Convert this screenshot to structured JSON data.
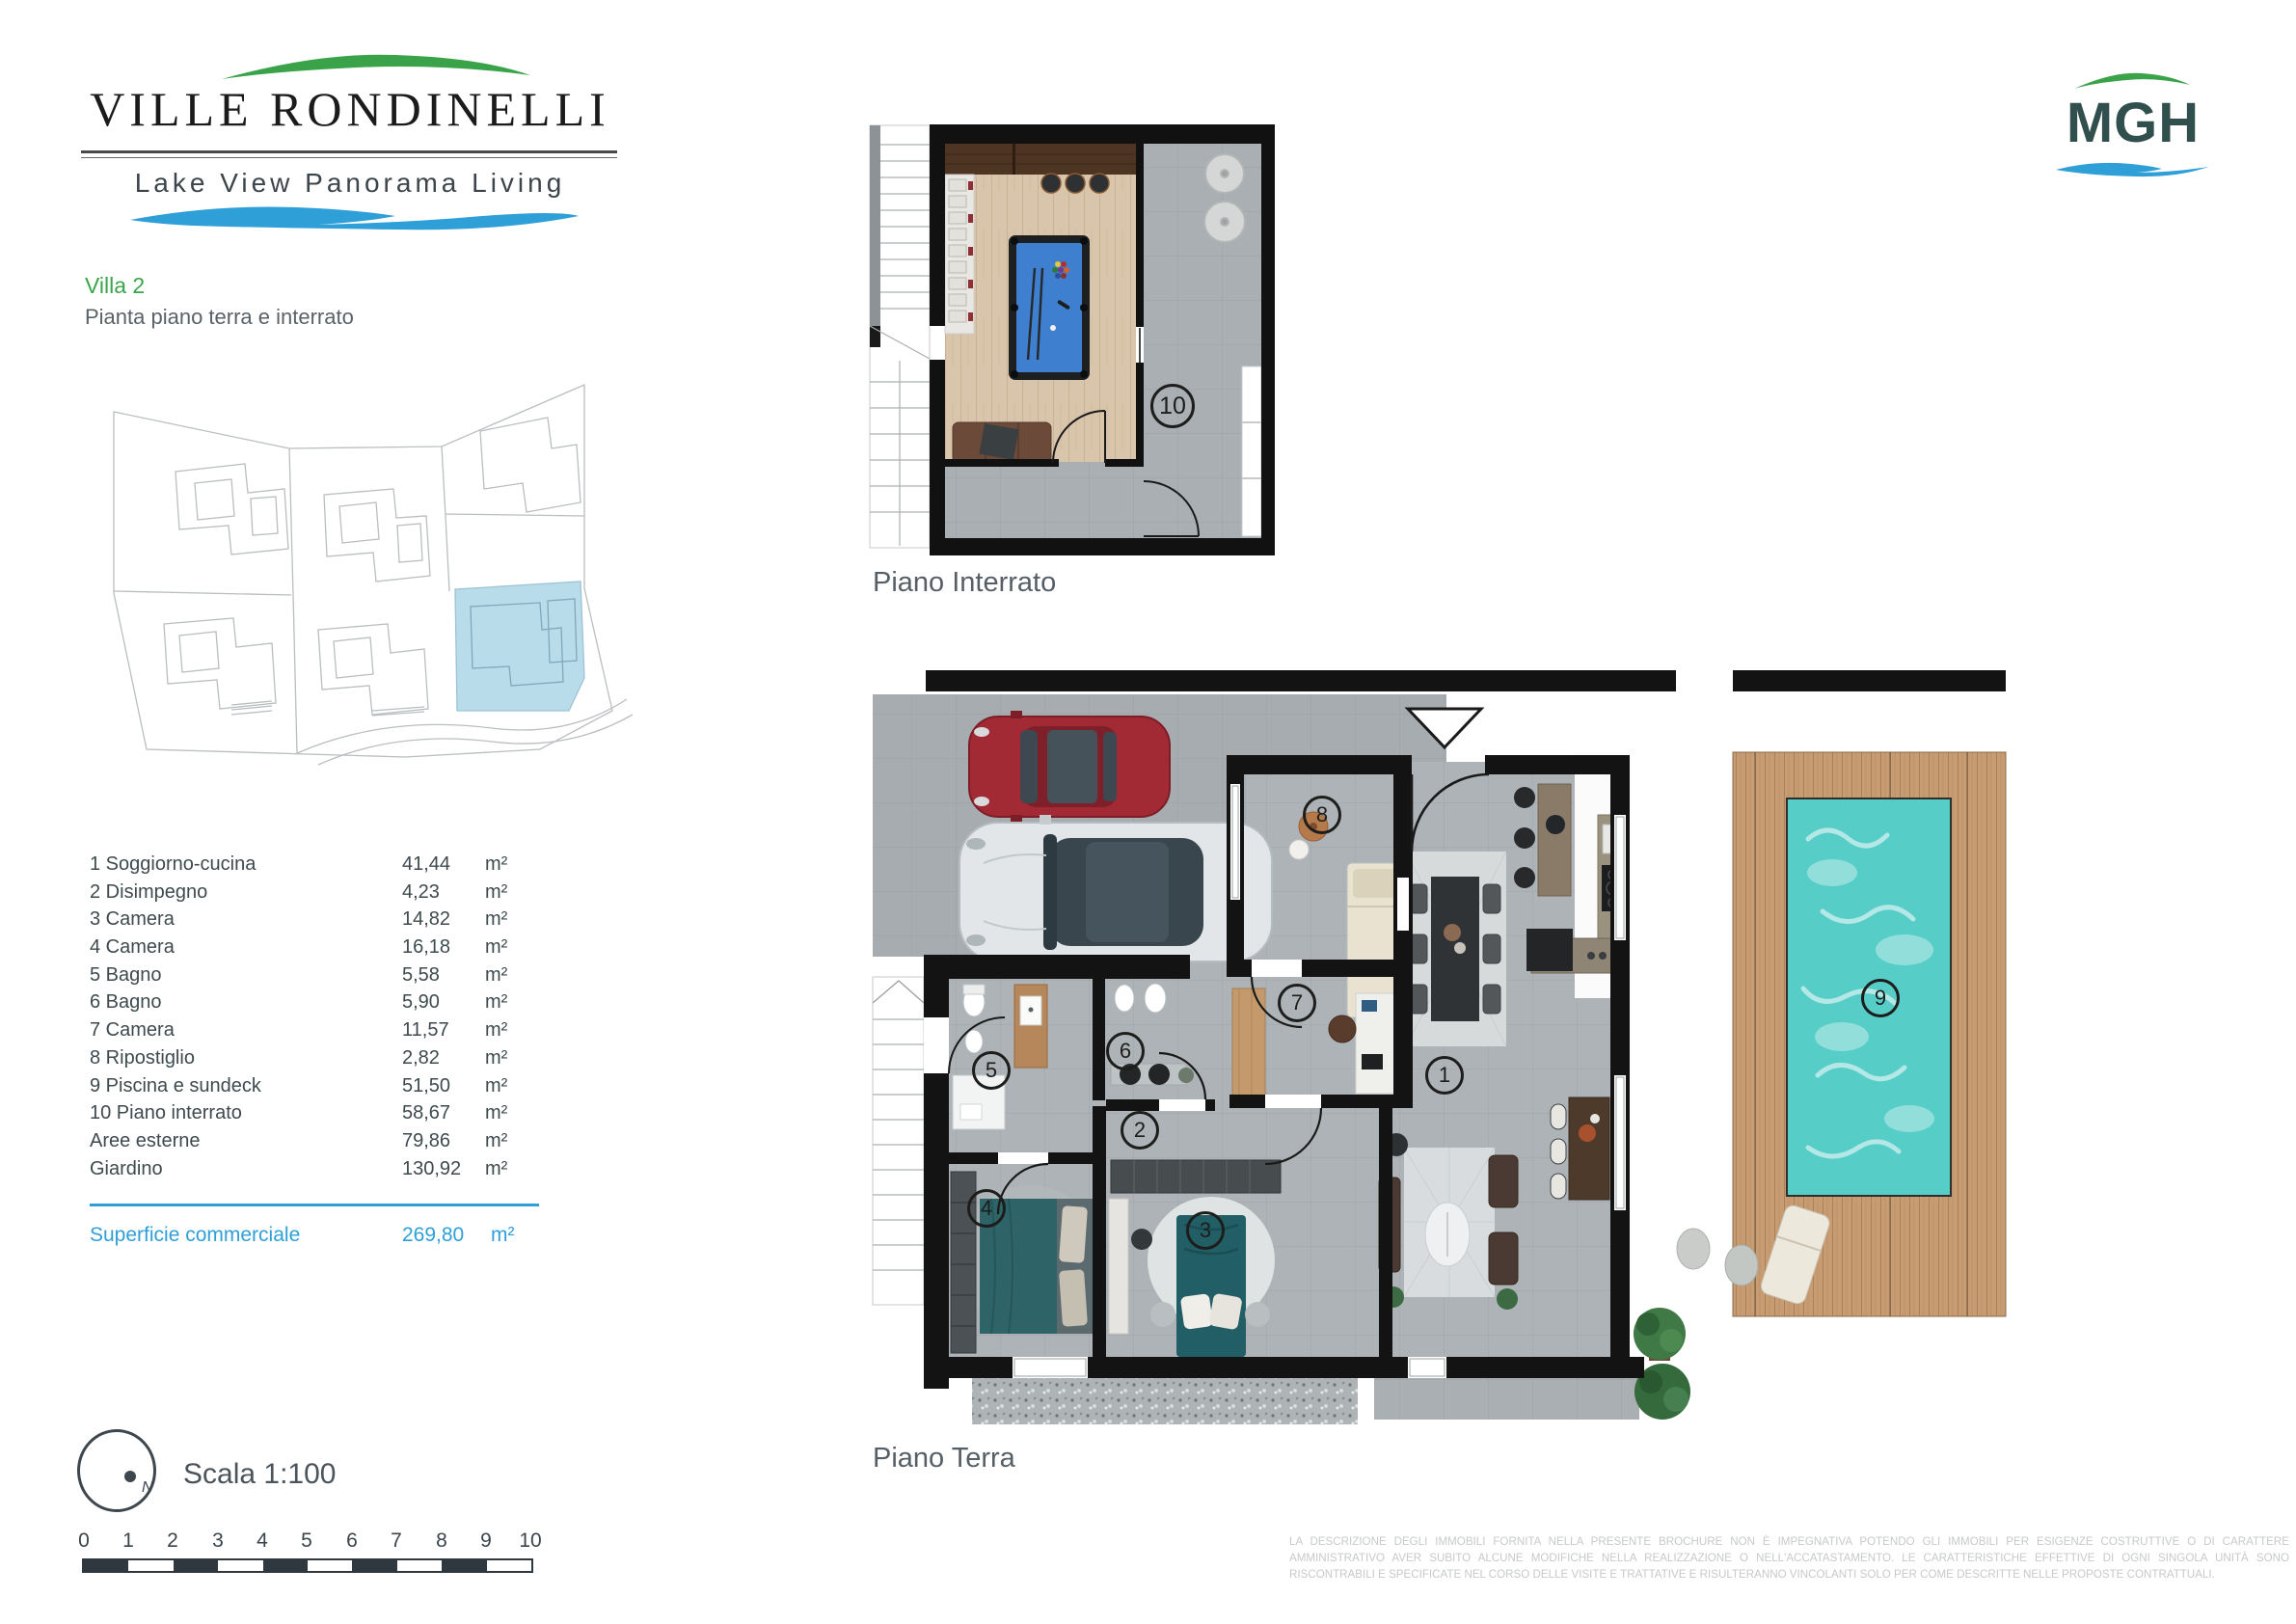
{
  "brand": {
    "title": "VILLE RONDINELLI",
    "subtitle": "Lake View Panorama Living",
    "green": "#3aa349",
    "blue": "#2f9fd8"
  },
  "partner_logo": {
    "text": "MGH"
  },
  "header": {
    "villa": "Villa 2",
    "subtitle": "Pianta piano terra e interrato"
  },
  "room_table": {
    "rows": [
      {
        "label": "1 Soggiorno-cucina",
        "value": "41,44",
        "unit": "m²"
      },
      {
        "label": "2 Disimpegno",
        "value": "4,23",
        "unit": "m²"
      },
      {
        "label": "3 Camera",
        "value": "14,82",
        "unit": "m²"
      },
      {
        "label": "4 Camera",
        "value": "16,18",
        "unit": "m²"
      },
      {
        "label": "5 Bagno",
        "value": "5,58",
        "unit": "m²"
      },
      {
        "label": "6 Bagno",
        "value": "5,90",
        "unit": "m²"
      },
      {
        "label": "7 Camera",
        "value": "11,57",
        "unit": "m²"
      },
      {
        "label": "8 Ripostiglio",
        "value": "2,82",
        "unit": "m²"
      },
      {
        "label": "9 Piscina e sundeck",
        "value": "51,50",
        "unit": "m²"
      },
      {
        "label": "10 Piano interrato",
        "value": "58,67",
        "unit": "m²"
      },
      {
        "label": "Aree esterne",
        "value": "79,86",
        "unit": "m²"
      },
      {
        "label": "Giardino",
        "value": "130,92",
        "unit": "m²"
      }
    ]
  },
  "total": {
    "label": "Superficie commerciale",
    "value": "269,80",
    "unit": "m²"
  },
  "compass": {
    "north_label": "N"
  },
  "scale": {
    "label": "Scala 1:100",
    "ticks": [
      "0",
      "1",
      "2",
      "3",
      "4",
      "5",
      "6",
      "7",
      "8",
      "9",
      "10"
    ]
  },
  "plans": {
    "interrato": {
      "caption": "Piano Interrato",
      "badges": {
        "b10": "10"
      }
    },
    "terra": {
      "caption": "Piano Terra",
      "badges": {
        "b1": "1",
        "b2": "2",
        "b3": "3",
        "b4": "4",
        "b5": "5",
        "b6": "6",
        "b7": "7",
        "b8": "8",
        "b9": "9"
      }
    }
  },
  "disclaimer": "LA DESCRIZIONE DEGLI IMMOBILI FORNITA NELLA PRESENTE BROCHURE NON È IMPEGNATIVA POTENDO GLI IMMOBILI PER ESIGENZE COSTRUTTIVE O DI CARATTERE AMMINISTRATIVO AVER SUBITO ALCUNE MODIFICHE NELLA REALIZZAZIONE O NELL'ACCATASTAMENTO. LE CARATTERISTICHE EFFETTIVE DI OGNI SINGOLA UNITÀ SONO RISCONTRABILI E SPECIFICATE NEL CORSO DELLE VISITE E TRATTATIVE E RISULTERANNO VINCOLANTI SOLO PER COME DESCRITTE  NELLE PROPOSTE CONTRATTUALI."
}
